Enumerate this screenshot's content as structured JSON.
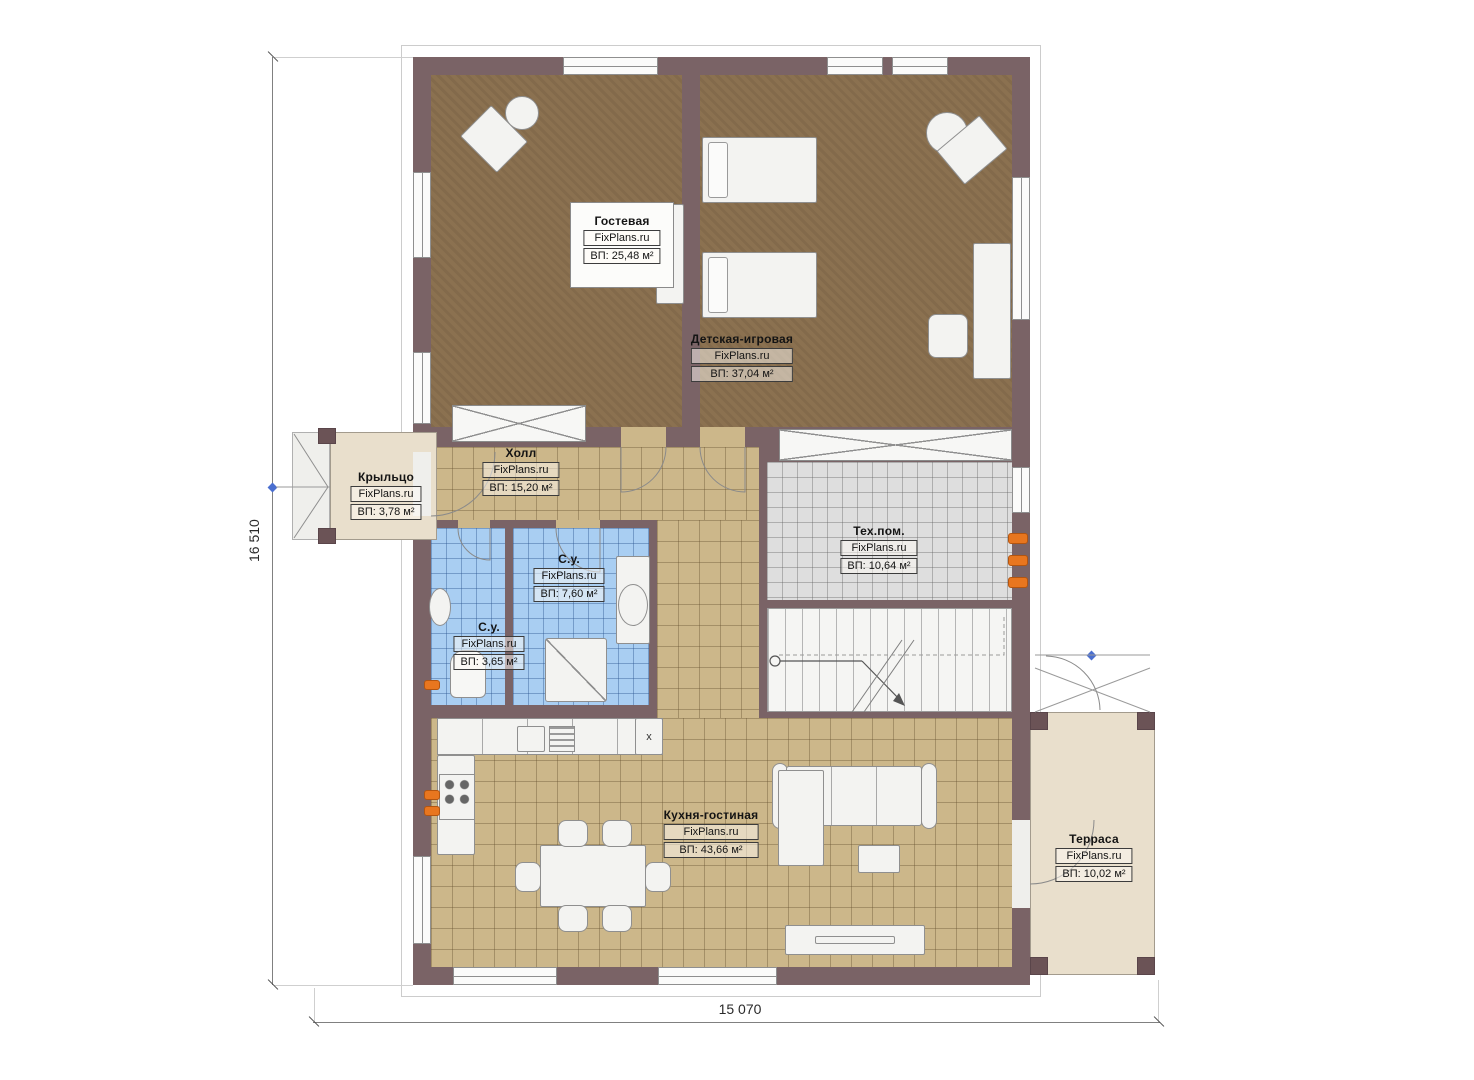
{
  "watermark": "FixPlans.ru",
  "rooms": [
    {
      "id": "guest",
      "name": "Гостевая",
      "brand": "FixPlans.ru",
      "area": "ВП: 25,48 м²"
    },
    {
      "id": "playroom",
      "name": "Детская-игровая",
      "brand": "FixPlans.ru",
      "area": "ВП: 37,04 м²"
    },
    {
      "id": "hall",
      "name": "Холл",
      "brand": "FixPlans.ru",
      "area": "ВП: 15,20 м²"
    },
    {
      "id": "porch",
      "name": "Крыльцо",
      "brand": "FixPlans.ru",
      "area": "ВП: 3,78 м²"
    },
    {
      "id": "tech-room",
      "name": "Тех.пом.",
      "brand": "FixPlans.ru",
      "area": "ВП: 10,64 м²"
    },
    {
      "id": "bathroom-large",
      "name": "С.у.",
      "brand": "FixPlans.ru",
      "area": "ВП: 7,60 м²"
    },
    {
      "id": "bathroom-small",
      "name": "С.у.",
      "brand": "FixPlans.ru",
      "area": "ВП: 3,65 м²"
    },
    {
      "id": "kitchen-living",
      "name": "Кухня-гостиная",
      "brand": "FixPlans.ru",
      "area": "ВП: 43,66 м²"
    },
    {
      "id": "terrace",
      "name": "Терраса",
      "brand": "FixPlans.ru",
      "area": "ВП: 10,02 м²"
    }
  ],
  "dimensions": {
    "left_total": "16 510",
    "bottom_total": "15 070"
  },
  "kitchen": {
    "appliance_mark": "x"
  },
  "colors": {
    "wall": "#7a6366",
    "carpet": "#8b7150",
    "tile_tan": "#ccb78a",
    "tile_blue": "#a9cef2",
    "tile_gray": "#dedede",
    "deck": "#e9dfcc",
    "radiator": "#e8761f"
  }
}
